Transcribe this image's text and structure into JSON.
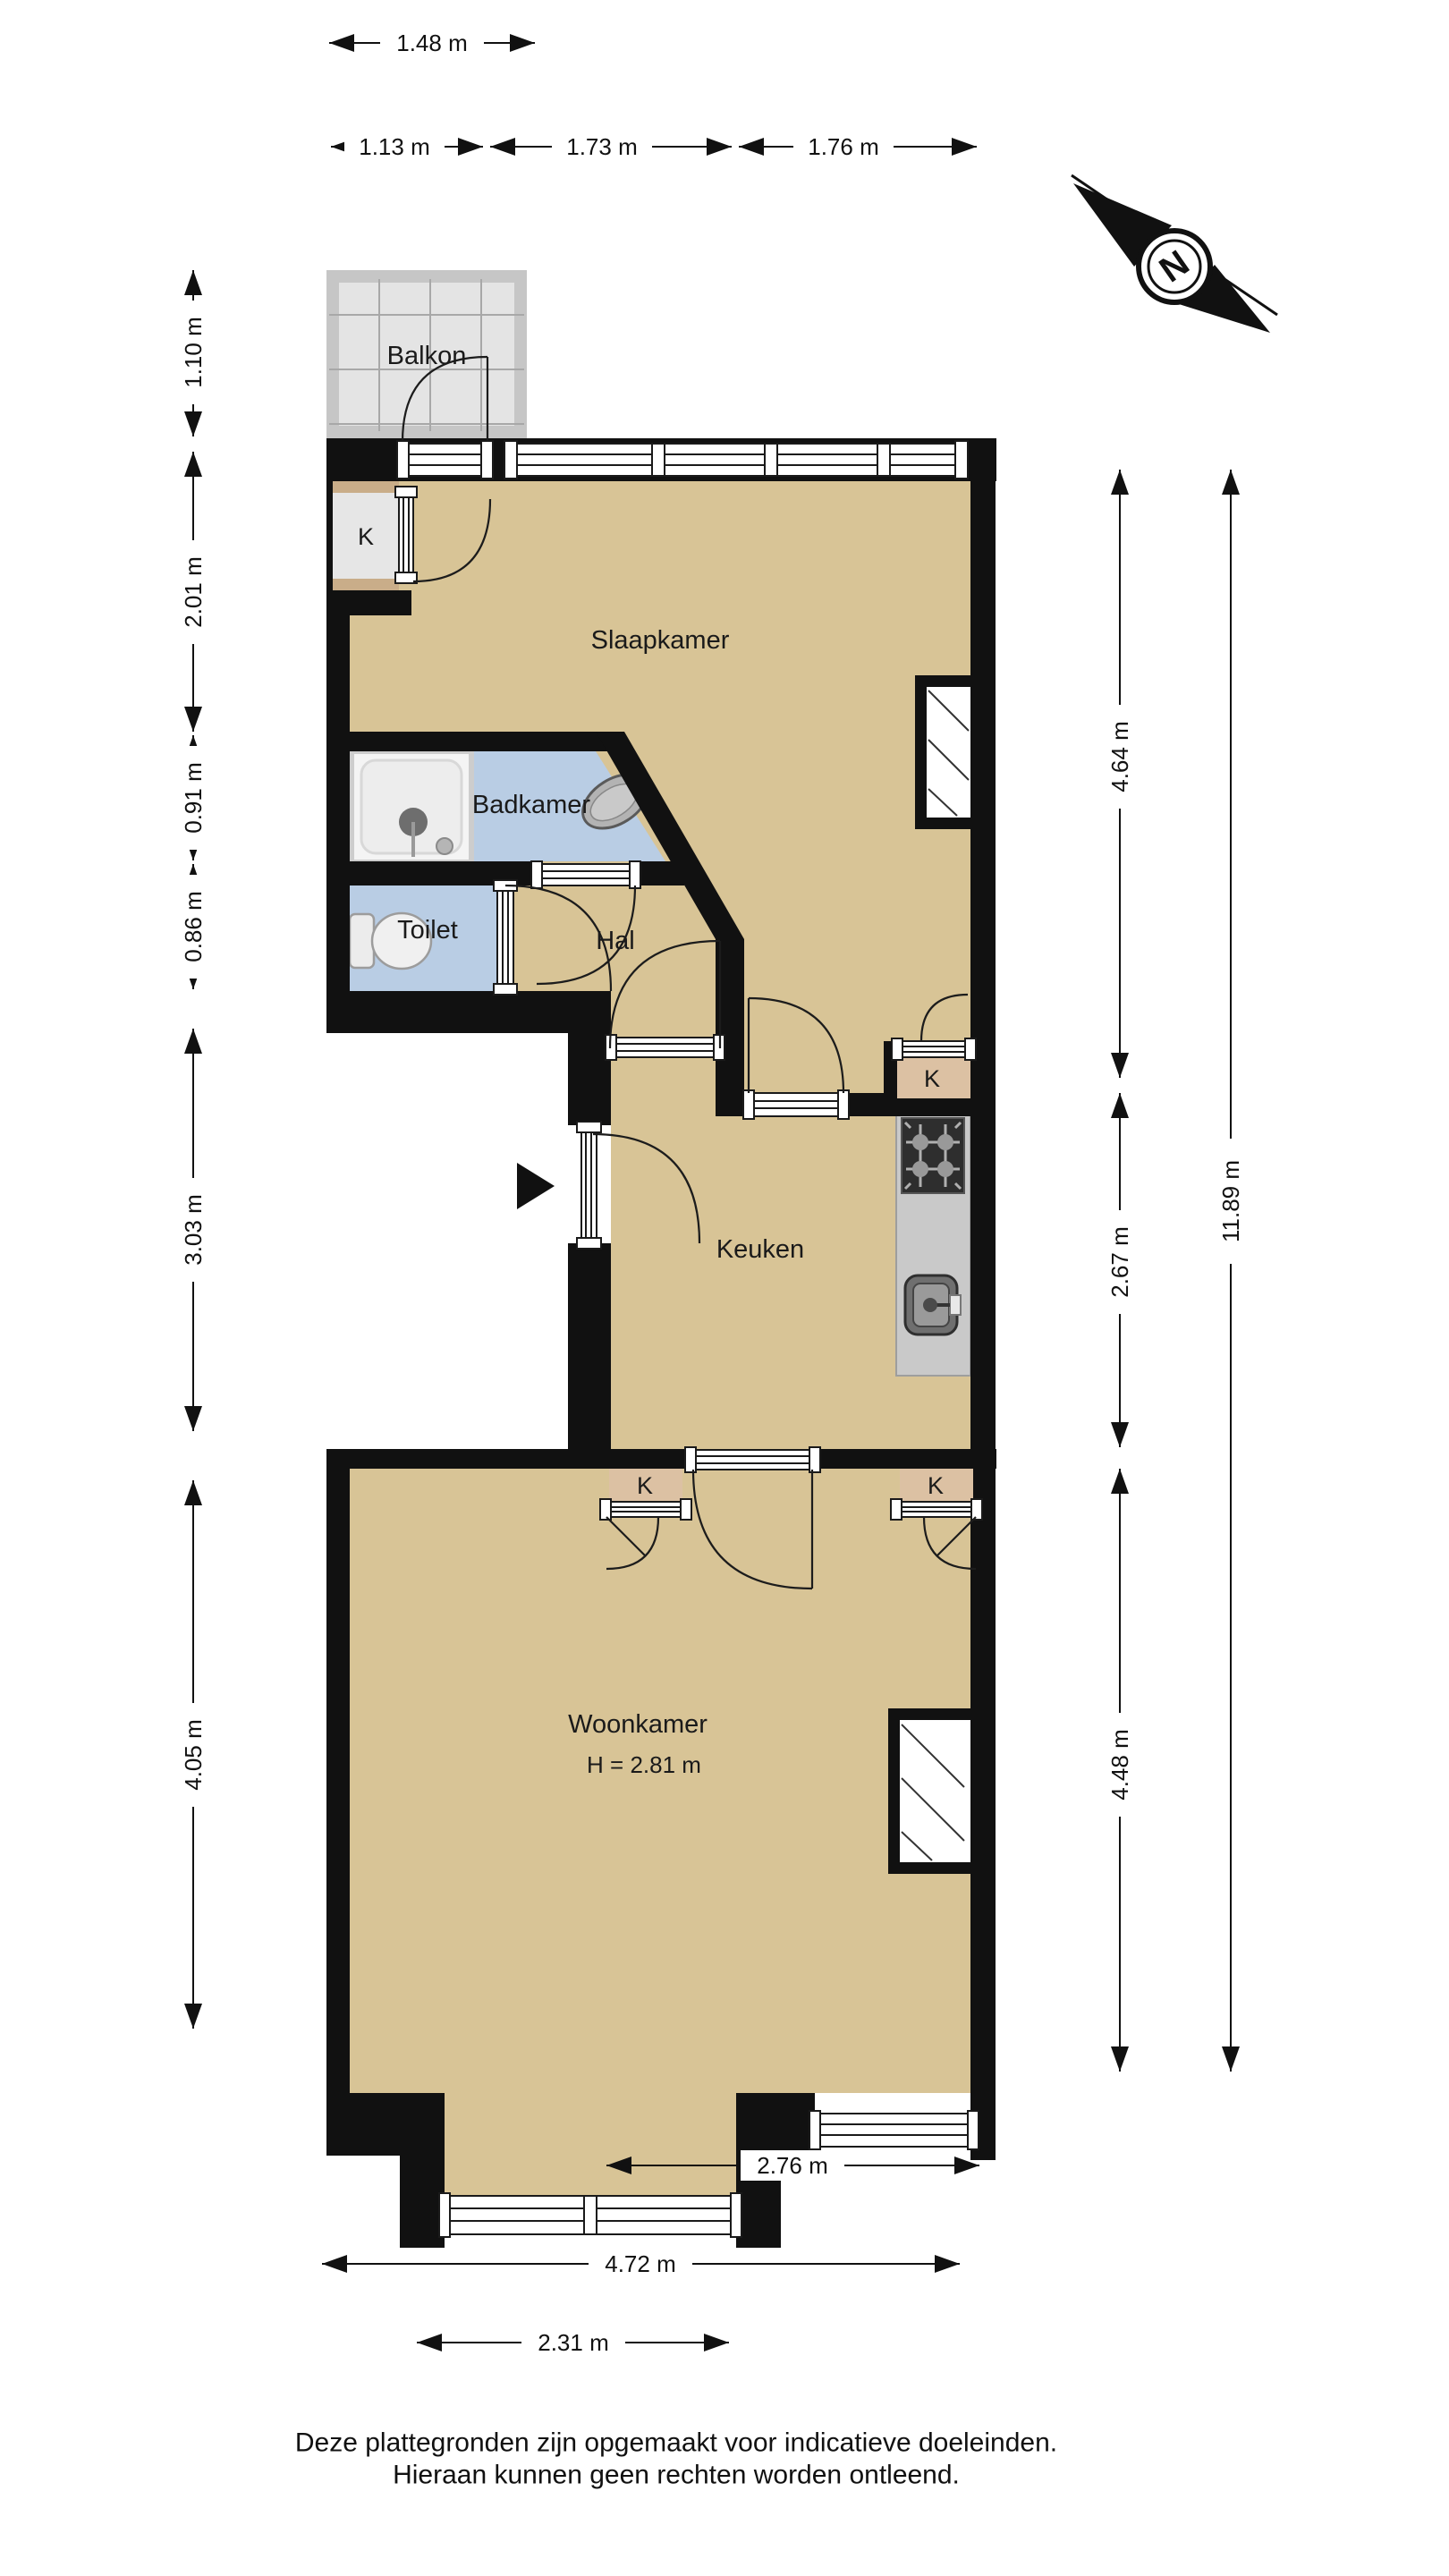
{
  "compass": {
    "label": "N"
  },
  "rooms": {
    "balkon": "Balkon",
    "slaapkamer": "Slaapkamer",
    "badkamer": "Badkamer",
    "toilet": "Toilet",
    "hal": "Hal",
    "keuken": "Keuken",
    "woonkamer": "Woonkamer",
    "woonkamer_ceiling_height": "H = 2.81 m",
    "closet": "K"
  },
  "dimensions": {
    "top": [
      "1.48 m"
    ],
    "top_row2": [
      "1.13 m",
      "1.73 m",
      "1.76 m"
    ],
    "left": [
      "1.10 m",
      "2.01 m",
      "0.91 m",
      "0.86 m",
      "3.03 m",
      "4.05 m"
    ],
    "right": [
      "4.64 m",
      "2.67 m",
      "4.48 m",
      "11.89 m"
    ],
    "bottom": [
      "2.76 m",
      "4.72 m",
      "2.31 m"
    ]
  },
  "footer": {
    "line1": "Deze plattegronden zijn opgemaakt voor indicatieve doeleinden.",
    "line2": "Hieraan kunnen geen rechten worden ontleend."
  },
  "colors": {
    "floor": "#d8c496",
    "wet_room": "#b9cde4",
    "closet_fill": "#dcc1a3",
    "balcony": "#e4e4e4",
    "wall": "#111111"
  }
}
